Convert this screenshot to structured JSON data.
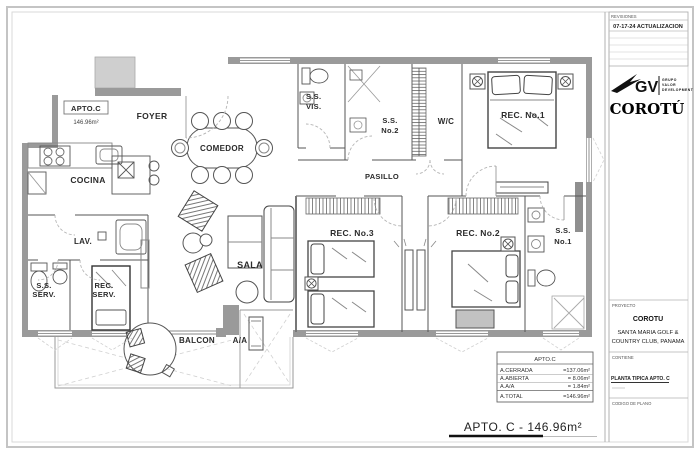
{
  "colors": {
    "wall": "#9a9a9a",
    "line": "#555555",
    "light_wall": "#cfcfcf",
    "frame": "#b0b0b0"
  },
  "sheet": {
    "title": "APTO. C - 146.96m²"
  },
  "unit_tag": {
    "name": "APTO.C",
    "area": "146.96m²"
  },
  "rooms": {
    "foyer": "FOYER",
    "comedor": "COMEDOR",
    "cocina": "COCINA",
    "lav": "LAV.",
    "ss_serv": [
      "S.S.",
      "SERV."
    ],
    "rec_serv": [
      "REC.",
      "SERV."
    ],
    "sala": "SALA",
    "balcon": "BALCON",
    "aa": "A/A",
    "ss_vis": [
      "S.S.",
      "VIS."
    ],
    "ss_no2": [
      "S.S.",
      "No.2"
    ],
    "wc": "W/C",
    "pasillo": "PASILLO",
    "rec_no1": "REC. No.1",
    "rec_no3": "REC. No.3",
    "rec_no2": "REC. No.2",
    "ss_no1": [
      "S.S.",
      "No.1"
    ]
  },
  "area_table": {
    "header": "APTO.C",
    "rows": [
      {
        "name": "A.CERRADA",
        "value": "=137.06m²"
      },
      {
        "name": "A.ABIERTA",
        "value": "= 8.06m²"
      },
      {
        "name": "A.A/A",
        "value": "= 1.84m²"
      },
      {
        "name": "A.TOTAL",
        "value": "=146.96m²"
      }
    ]
  },
  "title_block": {
    "revisions": {
      "header": "REVISIONES",
      "entry": "07-17-24 ACTUALIZACION"
    },
    "logo": {
      "monogram": "GV",
      "sub": [
        "GRUPO",
        "VALOR",
        "DEVELOPMENT"
      ],
      "brand": "COROTÚ"
    },
    "project": {
      "label": "PROYECTO",
      "name": "COROTU",
      "location1": "SANTA MARIA GOLF &",
      "location2": "COUNTRY CLUB, PANAMA"
    },
    "contains": {
      "label": "CONTIENE",
      "value": "PLANTA TIPICA APTO. C"
    },
    "code": {
      "label": "CODIGO DE PLANO"
    }
  }
}
